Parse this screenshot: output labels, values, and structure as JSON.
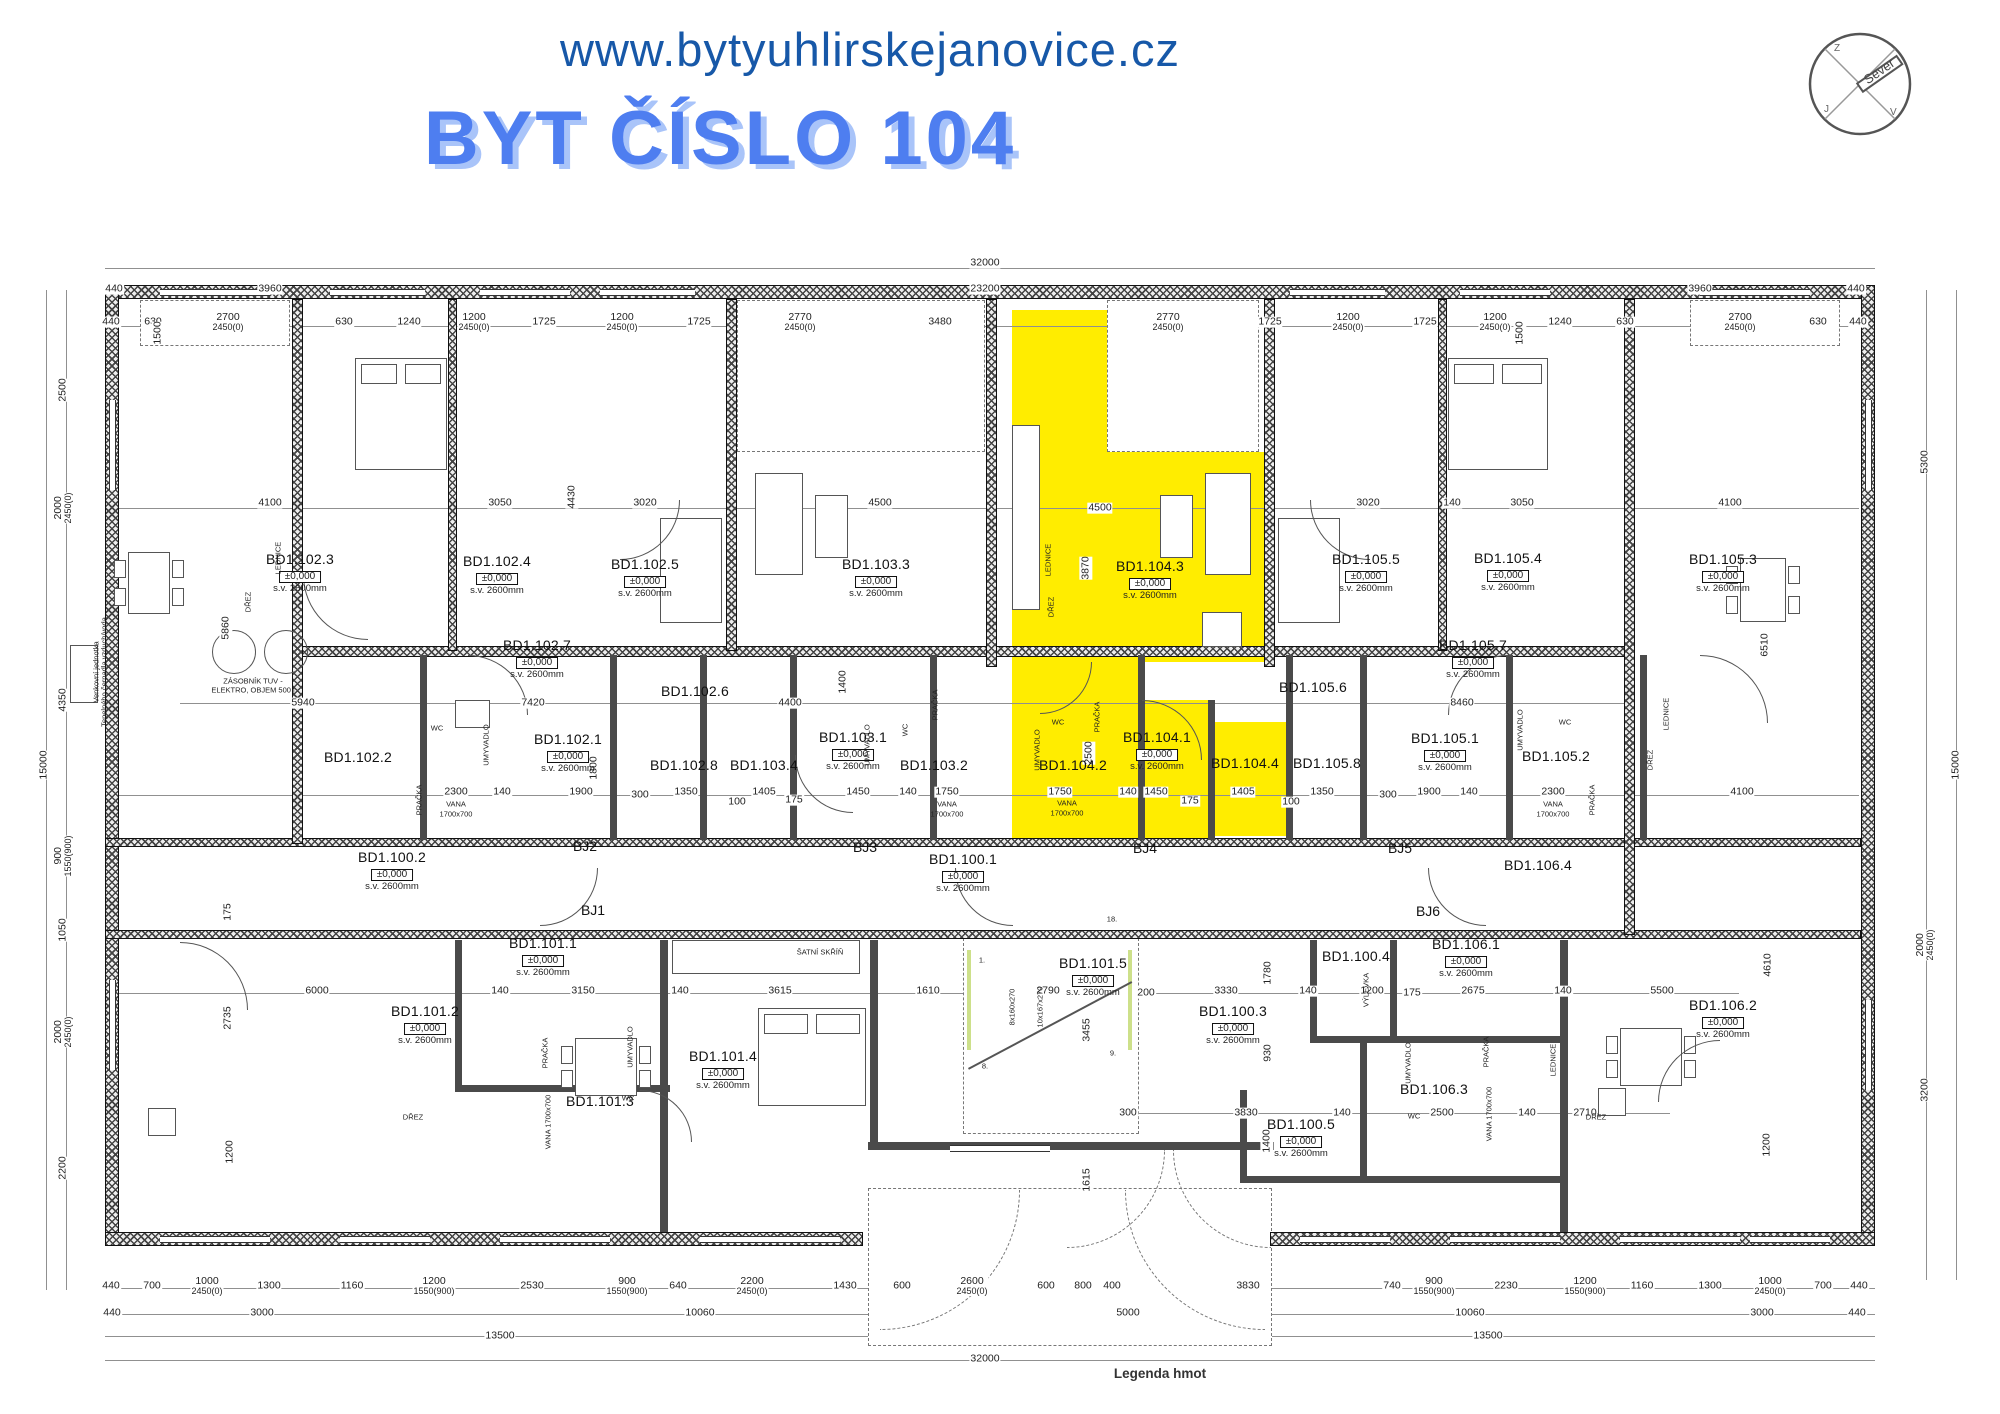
{
  "colors": {
    "highlight": "#FFED00",
    "title_blue": "#4E7EF0",
    "title_shadow": "#A9C4F9",
    "url_blue": "#1758A8"
  },
  "header": {
    "url": "www.bytyuhlirskejanovice.cz",
    "title": "BYT ČÍSLO 104"
  },
  "compass": {
    "label": "Sever",
    "letters": [
      {
        "t": "Z",
        "x": -26,
        "y": -33
      },
      {
        "t": "J",
        "x": -36,
        "y": 28
      },
      {
        "t": "V",
        "x": 30,
        "y": 31
      }
    ]
  },
  "caption": "Legenda hmot",
  "labels": {
    "elev": "±0,000",
    "sv": "s.v.  2600mm"
  },
  "rooms": [
    {
      "c": "BD1.102.3",
      "x": 300,
      "y": 558,
      "e": 1,
      "s": 1
    },
    {
      "c": "BD1.102.4",
      "x": 497,
      "y": 560,
      "e": 1,
      "s": 1
    },
    {
      "c": "BD1.102.5",
      "x": 645,
      "y": 563,
      "e": 1,
      "s": 1
    },
    {
      "c": "BD1.102.7",
      "x": 537,
      "y": 644,
      "e": 1,
      "s": 1
    },
    {
      "c": "BD1.102.6",
      "x": 695,
      "y": 690
    },
    {
      "c": "BD1.102.1",
      "x": 568,
      "y": 738,
      "e": 1,
      "s": 1
    },
    {
      "c": "BD1.102.2",
      "x": 358,
      "y": 756
    },
    {
      "c": "BD1.102.8",
      "x": 684,
      "y": 764
    },
    {
      "c": "BD1.103.4",
      "x": 764,
      "y": 764
    },
    {
      "c": "BD1.103.3",
      "x": 876,
      "y": 563,
      "e": 1,
      "s": 1
    },
    {
      "c": "BD1.103.1",
      "x": 853,
      "y": 736,
      "e": 1,
      "s": 1
    },
    {
      "c": "BD1.103.2",
      "x": 934,
      "y": 764
    },
    {
      "c": "BD1.104.3",
      "x": 1150,
      "y": 565,
      "e": 1,
      "s": 1
    },
    {
      "c": "BD1.104.1",
      "x": 1157,
      "y": 736,
      "e": 1,
      "s": 1
    },
    {
      "c": "BD1.104.2",
      "x": 1073,
      "y": 764
    },
    {
      "c": "BD1.104.4",
      "x": 1245,
      "y": 762
    },
    {
      "c": "BD1.105.5",
      "x": 1366,
      "y": 558,
      "e": 1,
      "s": 1
    },
    {
      "c": "BD1.105.4",
      "x": 1508,
      "y": 557,
      "e": 1,
      "s": 1
    },
    {
      "c": "BD1.105.3",
      "x": 1723,
      "y": 558,
      "e": 1,
      "s": 1
    },
    {
      "c": "BD1.105.7",
      "x": 1473,
      "y": 644,
      "e": 1,
      "s": 1
    },
    {
      "c": "BD1.105.6",
      "x": 1313,
      "y": 686
    },
    {
      "c": "BD1.105.8",
      "x": 1327,
      "y": 762
    },
    {
      "c": "BD1.105.1",
      "x": 1445,
      "y": 737,
      "e": 1,
      "s": 1
    },
    {
      "c": "BD1.105.2",
      "x": 1556,
      "y": 755
    },
    {
      "c": "BD1.106.4",
      "x": 1538,
      "y": 864
    },
    {
      "c": "BD1.100.2",
      "x": 392,
      "y": 856,
      "e": 1,
      "s": 1
    },
    {
      "c": "BD1.100.1",
      "x": 963,
      "y": 858,
      "e": 1,
      "s": 1
    },
    {
      "c": "BD1.101.1",
      "x": 543,
      "y": 942,
      "e": 1,
      "s": 1
    },
    {
      "c": "BD1.101.2",
      "x": 425,
      "y": 1010,
      "e": 1,
      "s": 1
    },
    {
      "c": "BD1.101.3",
      "x": 600,
      "y": 1100
    },
    {
      "c": "BD1.101.4",
      "x": 723,
      "y": 1055,
      "e": 1,
      "s": 1
    },
    {
      "c": "BD1.101.5",
      "x": 1093,
      "y": 962,
      "e": 1,
      "s": 1
    },
    {
      "c": "BD1.100.3",
      "x": 1233,
      "y": 1010,
      "e": 1,
      "s": 1
    },
    {
      "c": "BD1.100.4",
      "x": 1356,
      "y": 955
    },
    {
      "c": "BD1.106.1",
      "x": 1466,
      "y": 943,
      "e": 1,
      "s": 1
    },
    {
      "c": "BD1.106.3",
      "x": 1434,
      "y": 1088
    },
    {
      "c": "BD1.100.5",
      "x": 1301,
      "y": 1123,
      "e": 1,
      "s": 1
    },
    {
      "c": "BD1.106.2",
      "x": 1723,
      "y": 1004,
      "e": 1,
      "s": 1
    }
  ],
  "bj": [
    {
      "t": "BJ1",
      "x": 593,
      "y": 910
    },
    {
      "t": "BJ2",
      "x": 585,
      "y": 846
    },
    {
      "t": "BJ3",
      "x": 865,
      "y": 847
    },
    {
      "t": "BJ4",
      "x": 1145,
      "y": 848
    },
    {
      "t": "BJ5",
      "x": 1400,
      "y": 848
    },
    {
      "t": "BJ6",
      "x": 1428,
      "y": 911
    }
  ],
  "dims": [
    {
      "t": "32000",
      "x": 985,
      "y": 263
    },
    {
      "t": "440",
      "x": 114,
      "y": 289
    },
    {
      "t": "3960",
      "x": 270,
      "y": 289
    },
    {
      "t": "23200",
      "x": 985,
      "y": 289
    },
    {
      "t": "3960",
      "x": 1700,
      "y": 289
    },
    {
      "t": "440",
      "x": 1856,
      "y": 289
    },
    {
      "t": "440",
      "x": 111,
      "y": 322
    },
    {
      "t": "630",
      "x": 153,
      "y": 322
    },
    {
      "t": "2700",
      "t2": "2450(0)",
      "x": 228,
      "y": 322
    },
    {
      "t": "630",
      "x": 344,
      "y": 322
    },
    {
      "t": "1240",
      "x": 409,
      "y": 322
    },
    {
      "t": "1200",
      "t2": "2450(0)",
      "x": 474,
      "y": 322
    },
    {
      "t": "1725",
      "x": 544,
      "y": 322
    },
    {
      "t": "1200",
      "t2": "2450(0)",
      "x": 622,
      "y": 322
    },
    {
      "t": "1725",
      "x": 699,
      "y": 322
    },
    {
      "t": "2770",
      "t2": "2450(0)",
      "x": 800,
      "y": 322
    },
    {
      "t": "3480",
      "x": 940,
      "y": 322
    },
    {
      "t": "2770",
      "t2": "2450(0)",
      "x": 1168,
      "y": 322
    },
    {
      "t": "1725",
      "x": 1270,
      "y": 322
    },
    {
      "t": "1200",
      "t2": "2450(0)",
      "x": 1348,
      "y": 322
    },
    {
      "t": "1725",
      "x": 1425,
      "y": 322
    },
    {
      "t": "1200",
      "t2": "2450(0)",
      "x": 1495,
      "y": 322
    },
    {
      "t": "1240",
      "x": 1560,
      "y": 322
    },
    {
      "t": "630",
      "x": 1625,
      "y": 322
    },
    {
      "t": "2700",
      "t2": "2450(0)",
      "x": 1740,
      "y": 322
    },
    {
      "t": "630",
      "x": 1818,
      "y": 322
    },
    {
      "t": "440",
      "x": 1858,
      "y": 322
    },
    {
      "t": "440",
      "x": 111,
      "y": 1286
    },
    {
      "t": "700",
      "x": 152,
      "y": 1286
    },
    {
      "t": "1000",
      "t2": "2450(0)",
      "x": 207,
      "y": 1286
    },
    {
      "t": "1300",
      "x": 269,
      "y": 1286
    },
    {
      "t": "1160",
      "x": 352,
      "y": 1286
    },
    {
      "t": "1200",
      "t2": "1550(900)",
      "x": 434,
      "y": 1286
    },
    {
      "t": "2530",
      "x": 532,
      "y": 1286
    },
    {
      "t": "900",
      "t2": "1550(900)",
      "x": 627,
      "y": 1286
    },
    {
      "t": "640",
      "x": 678,
      "y": 1286
    },
    {
      "t": "2200",
      "t2": "2450(0)",
      "x": 752,
      "y": 1286
    },
    {
      "t": "1430",
      "x": 845,
      "y": 1286
    },
    {
      "t": "600",
      "x": 902,
      "y": 1286
    },
    {
      "t": "2600",
      "t2": "2450(0)",
      "x": 972,
      "y": 1286
    },
    {
      "t": "600",
      "x": 1046,
      "y": 1286
    },
    {
      "t": "800",
      "x": 1083,
      "y": 1286
    },
    {
      "t": "400",
      "x": 1112,
      "y": 1286
    },
    {
      "t": "3830",
      "x": 1248,
      "y": 1286
    },
    {
      "t": "740",
      "x": 1392,
      "y": 1286
    },
    {
      "t": "900",
      "t2": "1550(900)",
      "x": 1434,
      "y": 1286
    },
    {
      "t": "2230",
      "x": 1506,
      "y": 1286
    },
    {
      "t": "1200",
      "t2": "1550(900)",
      "x": 1585,
      "y": 1286
    },
    {
      "t": "1160",
      "x": 1642,
      "y": 1286
    },
    {
      "t": "1300",
      "x": 1710,
      "y": 1286
    },
    {
      "t": "1000",
      "t2": "2450(0)",
      "x": 1770,
      "y": 1286
    },
    {
      "t": "700",
      "x": 1823,
      "y": 1286
    },
    {
      "t": "440",
      "x": 1859,
      "y": 1286
    },
    {
      "t": "440",
      "x": 112,
      "y": 1313
    },
    {
      "t": "3000",
      "x": 262,
      "y": 1313
    },
    {
      "t": "10060",
      "x": 700,
      "y": 1313
    },
    {
      "t": "5000",
      "x": 1128,
      "y": 1313
    },
    {
      "t": "10060",
      "x": 1470,
      "y": 1313
    },
    {
      "t": "3000",
      "x": 1762,
      "y": 1313
    },
    {
      "t": "440",
      "x": 1857,
      "y": 1313
    },
    {
      "t": "13500",
      "x": 500,
      "y": 1336
    },
    {
      "t": "13500",
      "x": 1488,
      "y": 1336
    },
    {
      "t": "32000",
      "x": 985,
      "y": 1359
    },
    {
      "t": "15000",
      "x": 44,
      "y": 765,
      "v": 1
    },
    {
      "t": "2500",
      "x": 63,
      "y": 390,
      "v": 1
    },
    {
      "t": "2000",
      "t2": "2450(0)",
      "x": 63,
      "y": 508,
      "v": 1
    },
    {
      "t": "4350",
      "x": 63,
      "y": 700,
      "v": 1
    },
    {
      "t": "900",
      "t2": "1550(900)",
      "x": 63,
      "y": 856,
      "v": 1
    },
    {
      "t": "1050",
      "x": 63,
      "y": 930,
      "v": 1
    },
    {
      "t": "2000",
      "t2": "2450(0)",
      "x": 63,
      "y": 1032,
      "v": 1
    },
    {
      "t": "2200",
      "x": 63,
      "y": 1168,
      "v": 1
    },
    {
      "t": "5300",
      "x": 1925,
      "y": 462,
      "v": 1
    },
    {
      "t": "2000",
      "t2": "2450(0)",
      "x": 1925,
      "y": 945,
      "v": 1
    },
    {
      "t": "3200",
      "x": 1925,
      "y": 1090,
      "v": 1
    },
    {
      "t": "15000",
      "x": 1956,
      "y": 765,
      "v": 1
    },
    {
      "t": "4100",
      "x": 270,
      "y": 503
    },
    {
      "t": "3050",
      "x": 500,
      "y": 503
    },
    {
      "t": "3020",
      "x": 645,
      "y": 503
    },
    {
      "t": "4500",
      "x": 880,
      "y": 503
    },
    {
      "t": "4500",
      "x": 1100,
      "y": 508
    },
    {
      "t": "3020",
      "x": 1368,
      "y": 503
    },
    {
      "t": "140",
      "x": 1452,
      "y": 503
    },
    {
      "t": "3050",
      "x": 1522,
      "y": 503
    },
    {
      "t": "4100",
      "x": 1730,
      "y": 503
    },
    {
      "t": "1500",
      "x": 158,
      "y": 333,
      "v": 1
    },
    {
      "t": "1500",
      "x": 1520,
      "y": 333,
      "v": 1
    },
    {
      "t": "5860",
      "x": 226,
      "y": 628,
      "v": 1
    },
    {
      "t": "4430",
      "x": 572,
      "y": 497,
      "v": 1
    },
    {
      "t": "3870",
      "x": 1086,
      "y": 568,
      "v": 1
    },
    {
      "t": "6510",
      "x": 1765,
      "y": 645,
      "v": 1
    },
    {
      "t": "2500",
      "x": 1089,
      "y": 753,
      "v": 1
    },
    {
      "t": "1800",
      "x": 594,
      "y": 768,
      "v": 1
    },
    {
      "t": "1400",
      "x": 843,
      "y": 682,
      "v": 1
    },
    {
      "t": "2300",
      "x": 456,
      "y": 792
    },
    {
      "t": "140",
      "x": 502,
      "y": 792
    },
    {
      "t": "1900",
      "x": 581,
      "y": 792
    },
    {
      "t": "300",
      "x": 640,
      "y": 795
    },
    {
      "t": "1350",
      "x": 686,
      "y": 792
    },
    {
      "t": "100",
      "x": 737,
      "y": 802
    },
    {
      "t": "1405",
      "x": 764,
      "y": 792
    },
    {
      "t": "175",
      "x": 794,
      "y": 800
    },
    {
      "t": "1450",
      "x": 858,
      "y": 792
    },
    {
      "t": "140",
      "x": 908,
      "y": 792
    },
    {
      "t": "1750",
      "x": 947,
      "y": 792
    },
    {
      "t": "1750",
      "x": 1060,
      "y": 792
    },
    {
      "t": "140",
      "x": 1128,
      "y": 792
    },
    {
      "t": "1450",
      "x": 1156,
      "y": 792
    },
    {
      "t": "175",
      "x": 1190,
      "y": 801
    },
    {
      "t": "1405",
      "x": 1243,
      "y": 792
    },
    {
      "t": "100",
      "x": 1291,
      "y": 802
    },
    {
      "t": "1350",
      "x": 1322,
      "y": 792
    },
    {
      "t": "300",
      "x": 1388,
      "y": 795
    },
    {
      "t": "1900",
      "x": 1429,
      "y": 792
    },
    {
      "t": "140",
      "x": 1469,
      "y": 792
    },
    {
      "t": "2300",
      "x": 1553,
      "y": 792
    },
    {
      "t": "4100",
      "x": 1742,
      "y": 792
    },
    {
      "t": "5940",
      "x": 303,
      "y": 703
    },
    {
      "t": "7420",
      "x": 533,
      "y": 703
    },
    {
      "t": "4400",
      "x": 790,
      "y": 703
    },
    {
      "t": "8460",
      "x": 1462,
      "y": 703
    },
    {
      "t": "6000",
      "x": 317,
      "y": 991
    },
    {
      "t": "140",
      "x": 500,
      "y": 991
    },
    {
      "t": "3150",
      "x": 583,
      "y": 991
    },
    {
      "t": "140",
      "x": 680,
      "y": 991
    },
    {
      "t": "3615",
      "x": 780,
      "y": 991
    },
    {
      "t": "1610",
      "x": 928,
      "y": 991
    },
    {
      "t": "2790",
      "x": 1048,
      "y": 991
    },
    {
      "t": "200",
      "x": 1146,
      "y": 993
    },
    {
      "t": "3330",
      "x": 1226,
      "y": 991
    },
    {
      "t": "140",
      "x": 1308,
      "y": 991
    },
    {
      "t": "1200",
      "x": 1372,
      "y": 991
    },
    {
      "t": "175",
      "x": 1412,
      "y": 993
    },
    {
      "t": "2675",
      "x": 1473,
      "y": 991
    },
    {
      "t": "140",
      "x": 1563,
      "y": 991
    },
    {
      "t": "5500",
      "x": 1662,
      "y": 991
    },
    {
      "t": "2735",
      "x": 228,
      "y": 1018,
      "v": 1
    },
    {
      "t": "175",
      "x": 228,
      "y": 912,
      "v": 1
    },
    {
      "t": "1200",
      "x": 230,
      "y": 1152,
      "v": 1
    },
    {
      "t": "1780",
      "x": 1268,
      "y": 973,
      "v": 1
    },
    {
      "t": "930",
      "x": 1268,
      "y": 1053,
      "v": 1
    },
    {
      "t": "4610",
      "x": 1768,
      "y": 965,
      "v": 1
    },
    {
      "t": "1200",
      "x": 1767,
      "y": 1145,
      "v": 1
    },
    {
      "t": "3455",
      "x": 1087,
      "y": 1030,
      "v": 1
    },
    {
      "t": "1615",
      "x": 1087,
      "y": 1180,
      "v": 1
    },
    {
      "t": "1400",
      "x": 1267,
      "y": 1141,
      "v": 1
    },
    {
      "t": "300",
      "x": 1128,
      "y": 1113
    },
    {
      "t": "3830",
      "x": 1246,
      "y": 1113
    },
    {
      "t": "140",
      "x": 1342,
      "y": 1113
    },
    {
      "t": "2500",
      "x": 1442,
      "y": 1113
    },
    {
      "t": "140",
      "x": 1527,
      "y": 1113
    },
    {
      "t": "2710",
      "x": 1585,
      "y": 1113
    }
  ],
  "notes": [
    {
      "t": "LEDNICE",
      "x": 1048,
      "y": 560,
      "v": 1
    },
    {
      "t": "DŘEZ",
      "x": 1051,
      "y": 607,
      "v": 1
    },
    {
      "t": "LEDNICE",
      "x": 278,
      "y": 558,
      "v": 1
    },
    {
      "t": "DŘEZ",
      "x": 248,
      "y": 602,
      "v": 1
    },
    {
      "t": "WC",
      "x": 1058,
      "y": 722
    },
    {
      "t": "UMYVADLO",
      "x": 1037,
      "y": 750,
      "v": 1
    },
    {
      "t": "PRAČKA",
      "x": 1097,
      "y": 717,
      "v": 1
    },
    {
      "t": "VANA",
      "x": 1067,
      "y": 803
    },
    {
      "t": "1700x700",
      "x": 1067,
      "y": 813
    },
    {
      "t": "WC",
      "x": 437,
      "y": 728
    },
    {
      "t": "UMYVADLO",
      "x": 486,
      "y": 745,
      "v": 1
    },
    {
      "t": "PRAČKA",
      "x": 419,
      "y": 800,
      "v": 1
    },
    {
      "t": "VANA",
      "x": 456,
      "y": 804
    },
    {
      "t": "1700x700",
      "x": 456,
      "y": 814
    },
    {
      "t": "UMYVADLO",
      "x": 867,
      "y": 745,
      "v": 1
    },
    {
      "t": "WC",
      "x": 905,
      "y": 730,
      "v": 1
    },
    {
      "t": "PRAČKA",
      "x": 935,
      "y": 705,
      "v": 1
    },
    {
      "t": "VANA",
      "x": 947,
      "y": 804
    },
    {
      "t": "1700x700",
      "x": 947,
      "y": 814
    },
    {
      "t": "UMYVADLO",
      "x": 1520,
      "y": 730,
      "v": 1
    },
    {
      "t": "WC",
      "x": 1565,
      "y": 722
    },
    {
      "t": "PRAČKA",
      "x": 1592,
      "y": 800,
      "v": 1
    },
    {
      "t": "VANA",
      "x": 1553,
      "y": 804
    },
    {
      "t": "1700x700",
      "x": 1553,
      "y": 814
    },
    {
      "t": "DŘEZ",
      "x": 1650,
      "y": 760,
      "v": 1
    },
    {
      "t": "LEDNICE",
      "x": 1666,
      "y": 714,
      "v": 1
    },
    {
      "t": "UMYVADLO",
      "x": 630,
      "y": 1047,
      "v": 1
    },
    {
      "t": "WC",
      "x": 628,
      "y": 1098
    },
    {
      "t": "PRAČKA",
      "x": 545,
      "y": 1053,
      "v": 1
    },
    {
      "t": "VANA 1700x700",
      "x": 548,
      "y": 1122,
      "v": 1
    },
    {
      "t": "UMYVADLO",
      "x": 1408,
      "y": 1063,
      "v": 1
    },
    {
      "t": "WC",
      "x": 1414,
      "y": 1116
    },
    {
      "t": "PRAČKA",
      "x": 1486,
      "y": 1052,
      "v": 1
    },
    {
      "t": "VANA 1700x700",
      "x": 1489,
      "y": 1114,
      "v": 1
    },
    {
      "t": "LEDNICE",
      "x": 1553,
      "y": 1060,
      "v": 1
    },
    {
      "t": "VÝLEVKA",
      "x": 1366,
      "y": 990,
      "v": 1
    },
    {
      "t": "DŘEZ",
      "x": 413,
      "y": 1117
    },
    {
      "t": "DŘEZ",
      "x": 1596,
      "y": 1117
    },
    {
      "t": "ŠATNÍ SKŘÍŇ",
      "x": 820,
      "y": 952
    },
    {
      "t": "ZÁSOBNÍK TUV -",
      "x": 253,
      "y": 681
    },
    {
      "t": "ELEKTRO, OBJEM 500 l",
      "x": 253,
      "y": 690
    },
    {
      "t": "Venkovní jednotka",
      "x": 96,
      "y": 672,
      "v": 1
    },
    {
      "t": "Tepelného čerpadla vzduch/voda",
      "x": 104,
      "y": 672,
      "v": 1
    },
    {
      "t": "8x160x270",
      "x": 1012,
      "y": 1007,
      "v": 1
    },
    {
      "t": "10x167x270",
      "x": 1040,
      "y": 1007,
      "v": 1
    },
    {
      "t": "1.",
      "x": 982,
      "y": 960
    },
    {
      "t": "8.",
      "x": 985,
      "y": 1066
    },
    {
      "t": "9.",
      "x": 1113,
      "y": 1053
    },
    {
      "t": "18.",
      "x": 1112,
      "y": 919
    }
  ]
}
